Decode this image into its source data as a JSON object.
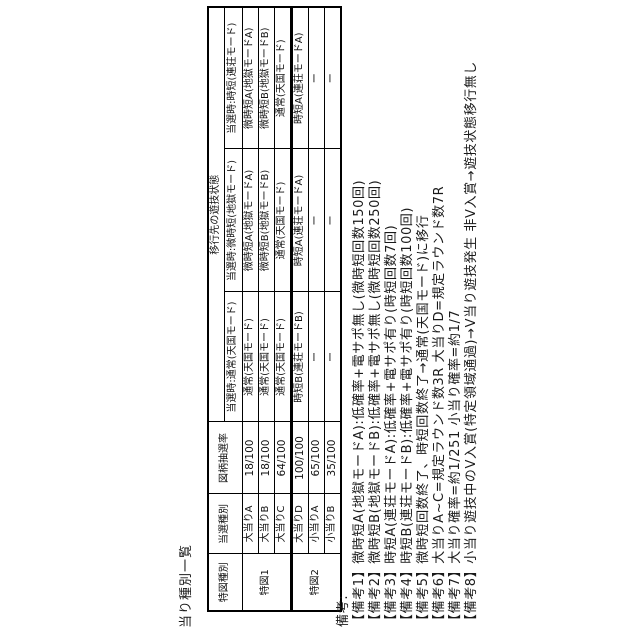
{
  "figure_title": "当り種別一覧",
  "table": {
    "headers": {
      "tokuzu": "特図種別",
      "tousen": "当選種別",
      "rate": "図柄抽選率",
      "transition": "移行先の遊技状態",
      "sub_columns": [
        "当選時:通常(天国モード)",
        "当選時:微時短(地獄モード)",
        "当選時:時短(連荘モード)"
      ]
    },
    "groups": [
      {
        "label": "特図1"
      },
      {
        "label": "特図2"
      }
    ],
    "rows": [
      {
        "type": "大当りA",
        "rate": "18/100",
        "at_normal": "通常(天国モード)",
        "at_bijitan": "微時短A(地獄モードA)",
        "at_jitan": "微時短A(地獄モードA)"
      },
      {
        "type": "大当りB",
        "rate": "18/100",
        "at_normal": "通常(天国モード)",
        "at_bijitan": "微時短B(地獄モードB)",
        "at_jitan": "微時短B(地獄モードB)"
      },
      {
        "type": "大当りC",
        "rate": "64/100",
        "at_normal": "通常(天国モード)",
        "at_bijitan": "通常(天国モード)",
        "at_jitan": "通常(天国モード)"
      },
      {
        "type": "大当りD",
        "rate": "100/100",
        "at_normal": "時短B(連荘モードB)",
        "at_bijitan": "時短A(連荘モードA)",
        "at_jitan": "時短A(連荘モードA)"
      },
      {
        "type": "小当りA",
        "rate": "65/100",
        "at_normal": "ー",
        "at_bijitan": "ー",
        "at_jitan": "ー"
      },
      {
        "type": "小当りB",
        "rate": "35/100",
        "at_normal": "ー",
        "at_bijitan": "ー",
        "at_jitan": "ー"
      }
    ]
  },
  "notes": {
    "label": "備考:",
    "items": [
      "【備考1】微時短A(地獄モードA):低確率+電サポ無し(微時短回数150回)",
      "【備考2】微時短B(地獄モードB):低確率+電サポ無し(微時短回数250回)",
      "【備考3】時短A(連荘モードA):低確率+電サポ有り(時短回数7回)",
      "【備考4】時短B(連荘モードB):低確率+電サポ有り(時短回数100回)",
      "【備考5】微時短回数終了、時短回数終了→通常(天国モード)に移行",
      "【備考6】大当りA~C=規定ラウンド数3R 大当りD=規定ラウンド数7R",
      "【備考7】大当り確率=約1/251 小当り確率=約1/7",
      "【備考8】小当り遊技中のV入賞(特定領域通過)→V当り遊技発生 非V入賞→遊技状態移行無し"
    ]
  }
}
